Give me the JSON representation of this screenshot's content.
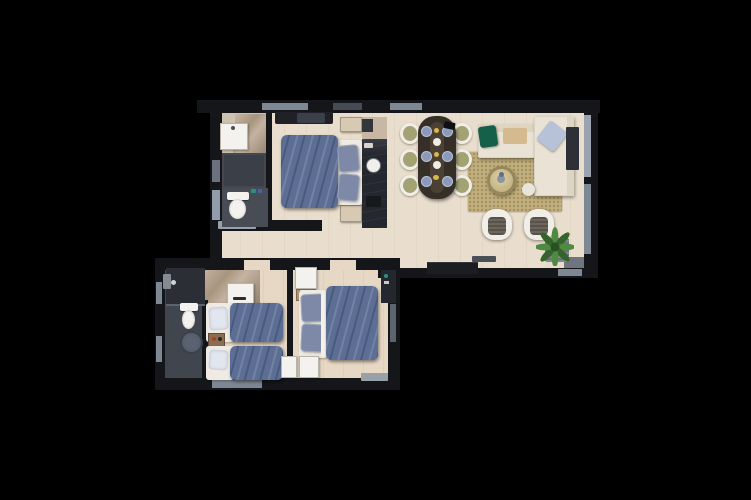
{
  "meta": {
    "description": "Top-down 3D rendered floor plan of an apartment on a black background",
    "canvas_width": 751,
    "canvas_height": 500
  },
  "palette": {
    "bg": "#000000",
    "wall": "#15161a",
    "window_grey": "#7e8794",
    "window_light": "#9aa3af",
    "door_grey": "#929caa",
    "floor_wood": "#e9decd",
    "floor_wood_lower": "#e7d8c5",
    "floor_bath": "#40454e",
    "shower_dark": "#2b2e35",
    "white_fixture": "#f4f2ee",
    "counter_dark": "#24272e",
    "cabinet_dark": "#3b3f47",
    "toilet_room": "#474c55",
    "cabinet_beige": "#c8b7a2",
    "bed_blue": "#5c6e94",
    "pillow_blue_grey": "#7d89a6",
    "pillow_white": "#e2e6ee",
    "mattress_white": "#efebe4",
    "table_wood": "#352f28",
    "chair_cream": "#f1eee7",
    "chair_olive": "#a2a273",
    "plate_blue": "#8b99ba",
    "accent_yellow": "#d9b84a",
    "sofa_cream": "#eae3d5",
    "pillow_green": "#156049",
    "throw_tan": "#d5ba8f",
    "pillow_light_blue": "#b6c2d7",
    "rug_olive": "#c0ae7c",
    "armchair_cushion": "#57534b",
    "plant_dark": "#35632c",
    "plant_light": "#4f8a41",
    "nightstand_beige": "#d8c9b2",
    "nightstand_wood": "#8a6e50",
    "stool_grey": "#5b6373",
    "mat_grey": "#9aa0a8",
    "bench_dark": "#1b1d21"
  },
  "rooms": [
    {
      "id": "bathroom-upper",
      "name": "bathroom with shower, vanity and toilet"
    },
    {
      "id": "master-bedroom",
      "name": "master bedroom with double bed"
    },
    {
      "id": "kitchen",
      "name": "kitchen counter strip with sink"
    },
    {
      "id": "dining-area",
      "name": "dining area with table for six"
    },
    {
      "id": "living-room",
      "name": "living room with corner sofa"
    },
    {
      "id": "hallway",
      "name": "connecting hallway"
    },
    {
      "id": "bathroom-lower",
      "name": "bathroom with shower enclosure and toilet"
    },
    {
      "id": "twin-bedroom",
      "name": "bedroom with two single beds"
    },
    {
      "id": "double-bedroom",
      "name": "bedroom with double bed"
    }
  ],
  "furniture": {
    "bathroom_upper": [
      "sink-vanity",
      "marble-shower",
      "storage-cabinet",
      "toilet",
      "toiletries"
    ],
    "master_bedroom": [
      "double-bed-blue-duvet",
      "two-blue-pillows",
      "nightstand-x2",
      "clothes-bench"
    ],
    "kitchen": [
      "upper-cabinet",
      "fridge",
      "dark-counter",
      "round-sink",
      "stove"
    ],
    "dining_area": [
      "dark-wood-table",
      "cream-olive-chairs-x6",
      "blue-plates-x6",
      "white-bowls-x2",
      "yellow-candles-x3"
    ],
    "living_room": [
      "cream-corner-sofa",
      "chaise",
      "green-cushion",
      "light-blue-cushion",
      "tan-throw",
      "olive-area-rug",
      "round-wicker-coffee-table",
      "white-pouf",
      "armchair-x2",
      "tv-bench",
      "potted-plant-on-bench",
      "dark-side-unit",
      "remote"
    ],
    "bathroom_lower": [
      "shower-enclosure",
      "shower-head",
      "toilet",
      "round-stool"
    ],
    "twin_bedroom": [
      "single-bed-x2-blue-duvets",
      "white-pillows",
      "wood-nightstand",
      "white-dresser",
      "marble-entry-tile"
    ],
    "double_bedroom": [
      "double-bed-blue-duvet",
      "two-blue-grey-pillows",
      "white-wardrobe-x3",
      "wood-nightstand",
      "dark-wardrobe",
      "doormat"
    ]
  }
}
